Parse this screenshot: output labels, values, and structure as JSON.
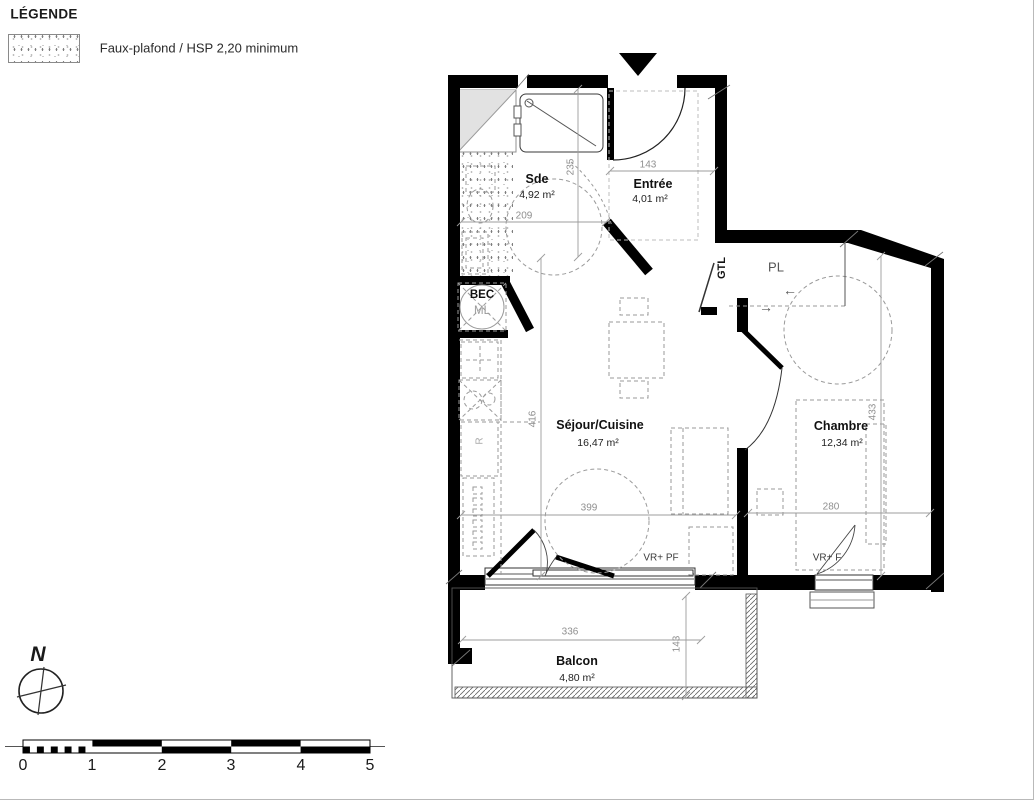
{
  "legend": {
    "title": "LÉGENDE",
    "item_label": "Faux-plafond / HSP 2,20 minimum"
  },
  "rooms": {
    "sde": {
      "name": "Sde",
      "area": "4,92 m²"
    },
    "entree": {
      "name": "Entrée",
      "area": "4,01 m²"
    },
    "sejour": {
      "name": "Séjour/Cuisine",
      "area": "16,47 m²"
    },
    "chambre": {
      "name": "Chambre",
      "area": "12,34 m²"
    },
    "balcon": {
      "name": "Balcon",
      "area": "4,80 m²"
    }
  },
  "annotations": {
    "bec": "BEC",
    "ml": "ML",
    "gtl": "GTL",
    "pl": "PL",
    "fridge": "R",
    "window_sejour": "VR+ PF",
    "window_chambre": "VR+ F",
    "pl_arrow_left": "←",
    "pl_arrow_right": "→"
  },
  "dimensions": {
    "entree_width": "143",
    "sde_width": "209",
    "sde_depth": "235",
    "sejour_depth": "416",
    "sejour_width": "399",
    "chambre_depth": "433",
    "chambre_width": "280",
    "balcon_width": "336",
    "balcon_depth": "143"
  },
  "compass": {
    "north": "N"
  },
  "scale_bar": {
    "ticks": [
      "0",
      "1",
      "2",
      "3",
      "4",
      "5"
    ]
  },
  "colors": {
    "wall": "#000000",
    "dim_text": "#8f8f8f",
    "dashed": "#9a9a9a",
    "label": "#1a1a1a"
  }
}
